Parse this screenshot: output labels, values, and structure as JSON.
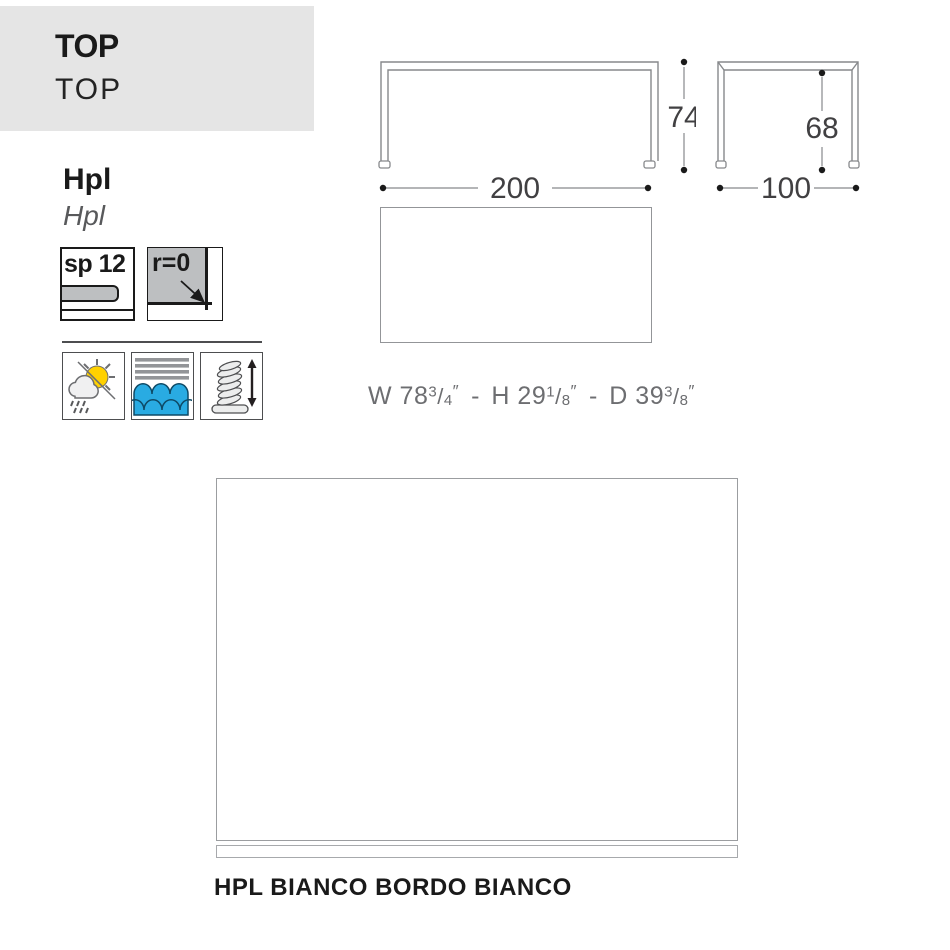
{
  "header": {
    "title": "TOP",
    "subtitle": "TOP"
  },
  "material": {
    "title": "Hpl",
    "subtitle": "Hpl"
  },
  "specs": {
    "thickness": {
      "label": "sp 12"
    },
    "radius": {
      "label": "r=0"
    }
  },
  "feature_icons": [
    {
      "id": "weatherproof-icon",
      "depicts": "sun, cloud and rain"
    },
    {
      "id": "water-resistant-icon",
      "depicts": "waves under stripes"
    },
    {
      "id": "adjustable-glide-icon",
      "depicts": "spring with vertical arrow"
    }
  ],
  "technical_drawing": {
    "front_view": {
      "width": "200",
      "height": "74"
    },
    "side_view": {
      "depth": "100",
      "inner_height": "68"
    }
  },
  "imperial_dimensions": {
    "separator": "-",
    "unit": "″",
    "parts": [
      {
        "prefix": "W",
        "whole": "78",
        "numerator": "3",
        "denominator": "4"
      },
      {
        "prefix": "H",
        "whole": "29",
        "numerator": "1",
        "denominator": "8"
      },
      {
        "prefix": "D",
        "whole": "39",
        "numerator": "3",
        "denominator": "8"
      }
    ]
  },
  "finish": {
    "label": "HPL BIANCO BORDO BIANCO"
  },
  "colors": {
    "header_bg": "#E5E5E5",
    "line_gray": "#87898C",
    "dim_text": "#414042",
    "fill_gray": "#BDBFC1",
    "stripe_gray": "#939598",
    "water_blue": "#29ABE2",
    "sun_yellow": "#FFD100",
    "ink": "#1A1A1A",
    "swatch_border": "#9B9DA0",
    "soft_text": "#58595B"
  }
}
